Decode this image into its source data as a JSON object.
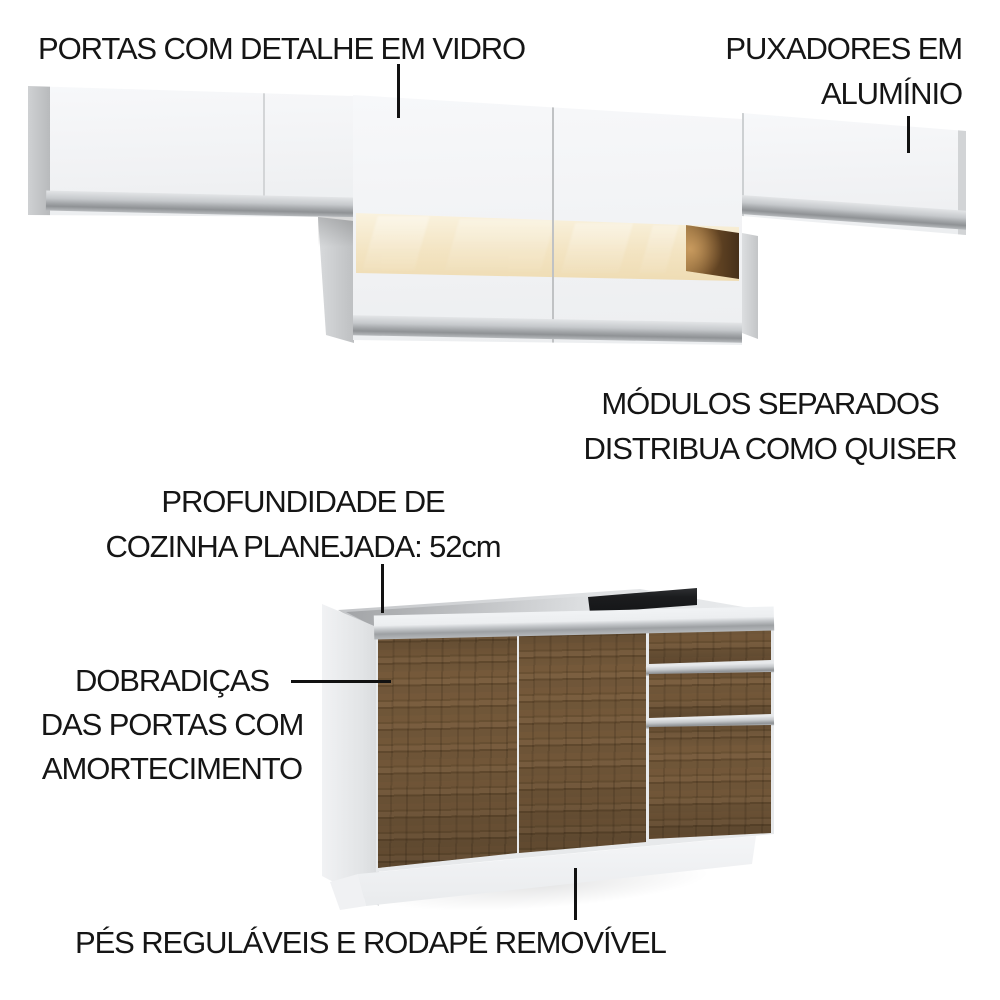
{
  "image_type": "product-feature-callout-image",
  "product": "modular kitchen cabinets (wall cabinets with glass detail + base cabinet)",
  "annotations": {
    "glass_doors": {
      "text": "PORTAS COM DETALHE EM VIDRO"
    },
    "aluminum_handles": {
      "line1": "PUXADORES EM",
      "line2": "ALUMÍNIO"
    },
    "modules": {
      "line1": "MÓDULOS SEPARADOS",
      "line2": "DISTRIBUA COMO QUISER"
    },
    "depth": {
      "line1": "PROFUNDIDADE DE",
      "line2": "COZINHA PLANEJADA: 52cm"
    },
    "hinges": {
      "line1": "DOBRADIÇAS",
      "line2": "DAS PORTAS COM",
      "line3": "AMORTECIMENTO"
    },
    "feet": {
      "text": "PÉS REGULÁVEIS E RODAPÉ REMOVÍVEL"
    }
  },
  "colors": {
    "background": "#ffffff",
    "annotation_text": "#151515",
    "callout_line": "#111111",
    "cabinet_white": "#f4f5f7",
    "side_panel_gray": "#c9cbcd",
    "aluminum_handle": "#a6a9ac",
    "glass_lit": "#f3e4c2",
    "glass_niche_wood": "#6b4a26",
    "base_wood": "#6f5637",
    "open_top_slot": "#1b1c1e"
  }
}
